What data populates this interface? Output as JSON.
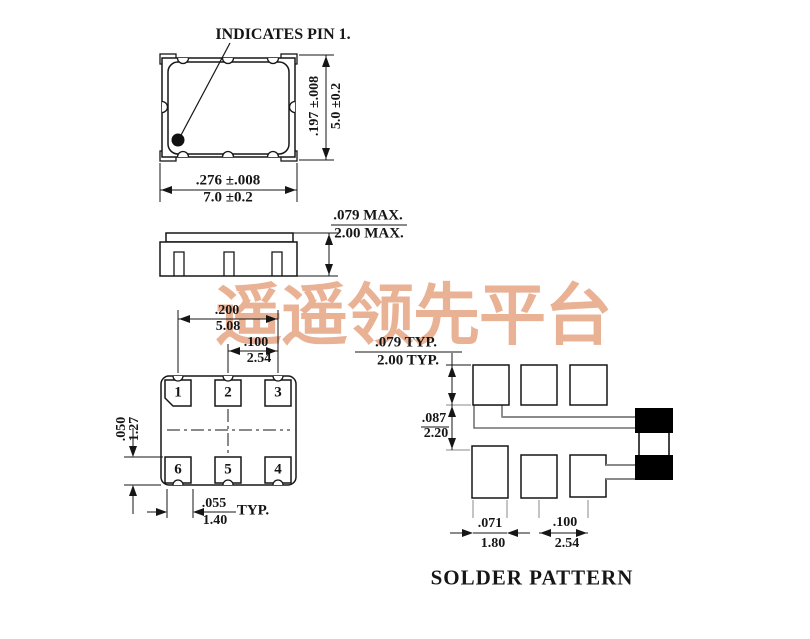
{
  "watermark": "遥遥领先平台",
  "colors": {
    "line": "#161616",
    "gray": "#8a8a8a",
    "watermark": "#e9b295",
    "fill_pad": "#000000"
  },
  "top_view": {
    "callout": "INDICATES PIN 1.",
    "height_dim": {
      "inch": ".197 ±.008",
      "mm": "5.0 ±0.2"
    },
    "width_dim": {
      "inch": ".276 ±.008",
      "mm": "7.0 ±0.2"
    }
  },
  "side_view": {
    "height_dim": {
      "inch": ".079 MAX.",
      "mm": "2.00 MAX."
    }
  },
  "bottom_view": {
    "pads": [
      "1",
      "2",
      "3",
      "6",
      "5",
      "4"
    ],
    "span_dim": {
      "inch": ".200",
      "mm": "5.08"
    },
    "pitch_dim": {
      "inch": ".100",
      "mm": "2.54"
    },
    "pad_height_dim": {
      "inch": ".050",
      "mm": "1.27"
    },
    "pad_width_dim": {
      "inch": ".055",
      "mm": "1.40",
      "suffix": "TYP."
    }
  },
  "solder_pattern": {
    "title": "SOLDER PATTERN",
    "pad_height_dim": {
      "inch": ".079 TYP.",
      "mm": "2.00 TYP."
    },
    "row_gap_dim": {
      "inch": ".087",
      "mm": "2.20"
    },
    "pad_width_dim": {
      "inch": ".071",
      "mm": "1.80"
    },
    "pitch_dim": {
      "inch": ".100",
      "mm": "2.54"
    }
  }
}
